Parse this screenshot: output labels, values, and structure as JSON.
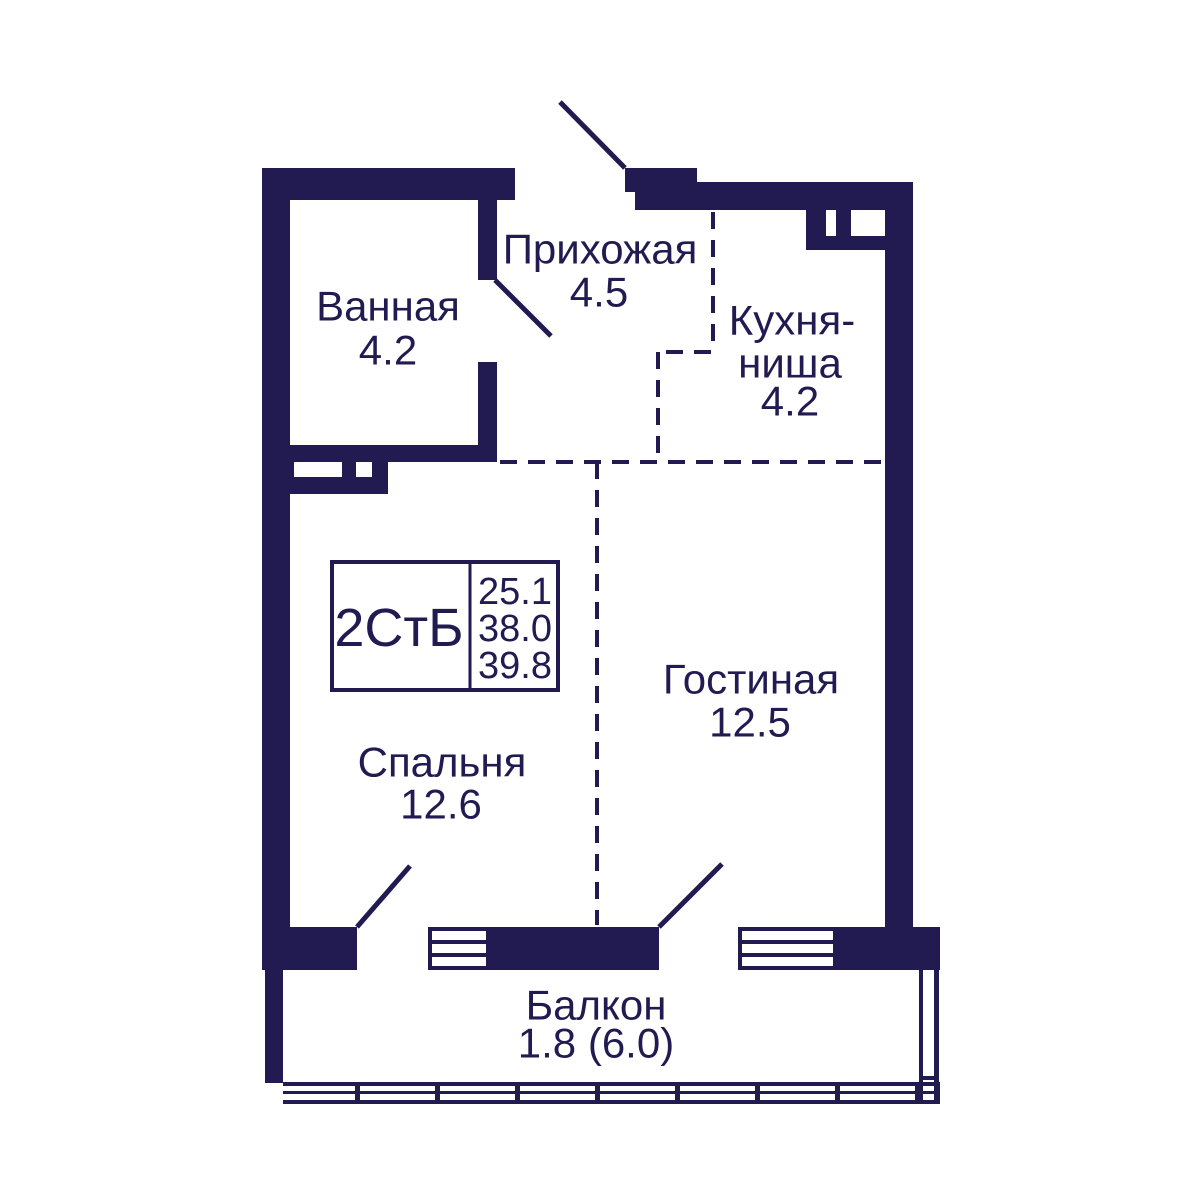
{
  "colors": {
    "wall": "#221b52",
    "background": "#ffffff"
  },
  "info_box": {
    "type_label": "2СтБ",
    "values": [
      "25.1",
      "38.0",
      "39.8"
    ]
  },
  "rooms": {
    "bathroom": {
      "name": "Ванная",
      "area": "4.2"
    },
    "hallway": {
      "name": "Прихожая",
      "area": "4.5"
    },
    "kitchen": {
      "name_line1": "Кухня-",
      "name_line2": "ниша",
      "area": "4.2"
    },
    "living": {
      "name": "Гостиная",
      "area": "12.5"
    },
    "bedroom": {
      "name": "Спальня",
      "area": "12.6"
    },
    "balcony": {
      "name": "Балкон",
      "area": "1.8 (6.0)"
    }
  }
}
